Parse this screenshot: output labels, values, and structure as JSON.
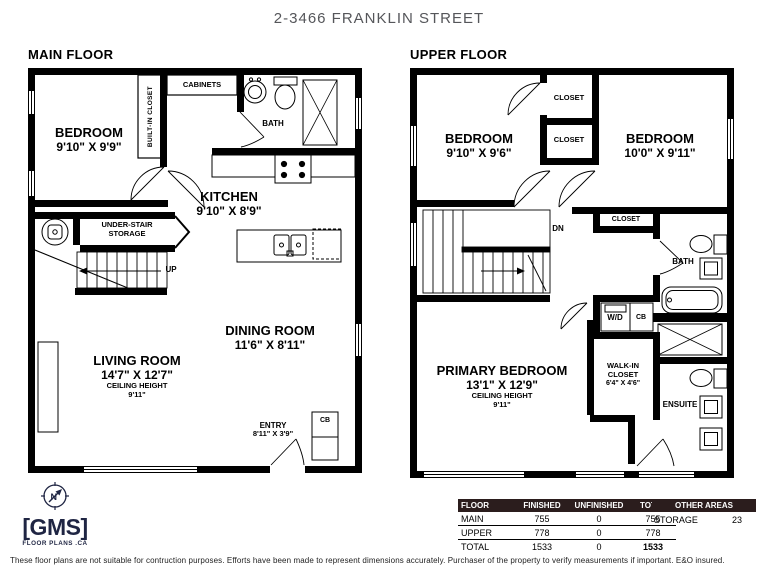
{
  "title": "2-3466 FRANKLIN STREET",
  "main_floor": {
    "label": "MAIN FLOOR",
    "bedroom": {
      "name": "BEDROOM",
      "dims": "9'10\" X 9'9\""
    },
    "built_in_closet": "BUILT-IN CLOSET",
    "cabinets": "CABINETS",
    "bath": "BATH",
    "kitchen": {
      "name": "KITCHEN",
      "dims": "9'10\" X 8'9\""
    },
    "under_stair_line1": "UNDER-STAIR",
    "under_stair_line2": "STORAGE",
    "up": "UP",
    "dining": {
      "name": "DINING ROOM",
      "dims": "11'6\" X 8'11\""
    },
    "living": {
      "name": "LIVING ROOM",
      "dims": "14'7\" X 12'7\"",
      "ceiling_label": "CEILING HEIGHT",
      "ceiling_value": "9'11\""
    },
    "entry": {
      "name": "ENTRY",
      "dims": "8'11\" X 3'9\""
    },
    "cb": "CB"
  },
  "upper_floor": {
    "label": "UPPER FLOOR",
    "bedroom_left": {
      "name": "BEDROOM",
      "dims": "9'10\" X 9'6\""
    },
    "bedroom_right": {
      "name": "BEDROOM",
      "dims": "10'0\" X 9'11\""
    },
    "closet_top": "CLOSET",
    "closet_mid": "CLOSET",
    "closet_right": "CLOSET",
    "dn": "DN",
    "bath": "BATH",
    "wd": "W/D",
    "cb": "CB",
    "primary": {
      "name": "PRIMARY BEDROOM",
      "dims": "13'1\" X 12'9\"",
      "ceiling_label": "CEILING HEIGHT",
      "ceiling_value": "9'11\""
    },
    "walk_in": {
      "line1": "WALK-IN",
      "line2": "CLOSET",
      "dims": "6'4\" X 4'6\""
    },
    "ensuite": "ENSUITE"
  },
  "area_table": {
    "headers": [
      "FLOOR",
      "FINISHED",
      "UNFINISHED",
      "TOTAL"
    ],
    "rows": [
      [
        "MAIN",
        "755",
        "0",
        "755"
      ],
      [
        "UPPER",
        "778",
        "0",
        "778"
      ],
      [
        "TOTAL",
        "1533",
        "0",
        "1533"
      ]
    ]
  },
  "other_areas": {
    "header": "OTHER AREAS",
    "label": "STORAGE",
    "value": "23"
  },
  "logo": {
    "gms": "[GMS]",
    "tagline": "FLOOR PLANS .CA"
  },
  "disclaimer": "These floor plans are not suitable for contruction purposes. Efforts have been made to represent dimensions accurately. Purchaser of the property to verify measurements if important. E&O insured.",
  "colors": {
    "wall": "#000000",
    "table_header_bg": "#2b1d1d",
    "logo_navy": "#1f2543",
    "title_gray": "#55565a"
  }
}
